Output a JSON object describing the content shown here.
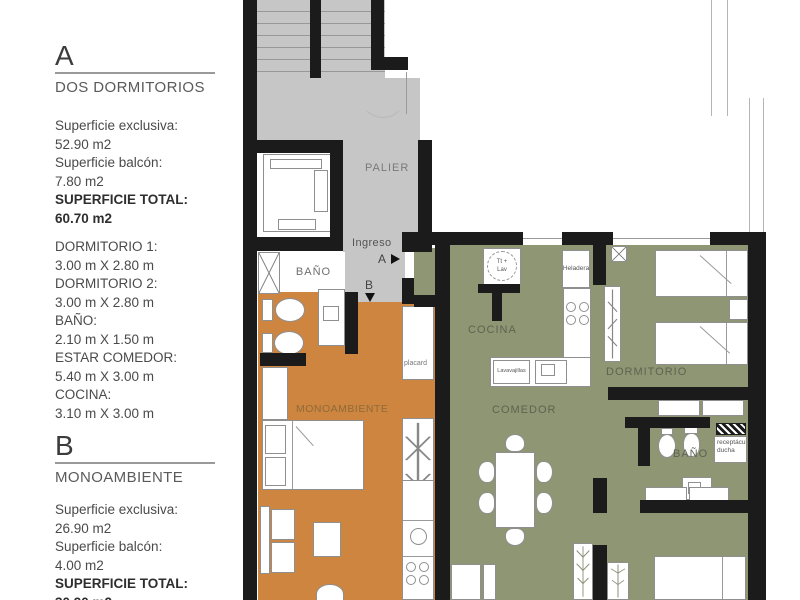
{
  "panel": {
    "sections": [
      {
        "letter": "A",
        "title": "DOS DORMITORIOS",
        "lines": [
          "Superficie exclusiva:",
          "52.90 m2",
          "Superficie balcón:",
          "7.80 m2",
          "SUPERFICIE TOTAL:",
          "60.70 m2"
        ],
        "rooms": [
          "DORMITORIO 1:",
          "3.00 m X 2.80 m",
          "DORMITORIO 2:",
          "3.00 m X 2.80 m",
          "BAÑO:",
          "2.10 m X 1.50 m",
          "ESTAR COMEDOR:",
          "5.40 m X 3.00 m",
          "COCINA:",
          "3.10 m X 3.00 m"
        ]
      },
      {
        "letter": "B",
        "title": "MONOAMBIENTE",
        "lines": [
          "Superficie exclusiva:",
          "26.90 m2",
          "Superficie balcón:",
          "4.00 m2",
          "SUPERFICIE TOTAL:",
          "30.90 m2"
        ]
      }
    ]
  },
  "plan": {
    "labels": {
      "palier": "PALIER",
      "ingreso": "Ingreso",
      "marker_a": "A",
      "marker_b": "B",
      "bano_b": "BAÑO",
      "monoambiente": "MONOAMBIENTE",
      "placard": "placard",
      "cocina": "COCINA",
      "comedor": "COMEDOR",
      "dormitorio": "DORMITORIO",
      "bano_a": "BAÑO",
      "ducha_line1": "receptáculo",
      "ducha_line2": "ducha",
      "heladera": "Heladera",
      "lavavajillas": "Lavavajillas",
      "termo_line1": "Tt +",
      "termo_line2": "Lav"
    },
    "colors": {
      "unit_a_floor": "#8e9674",
      "unit_b_floor": "#cd8540",
      "circulation": "#c6c6c6",
      "wall": "#1b1b1b"
    }
  }
}
